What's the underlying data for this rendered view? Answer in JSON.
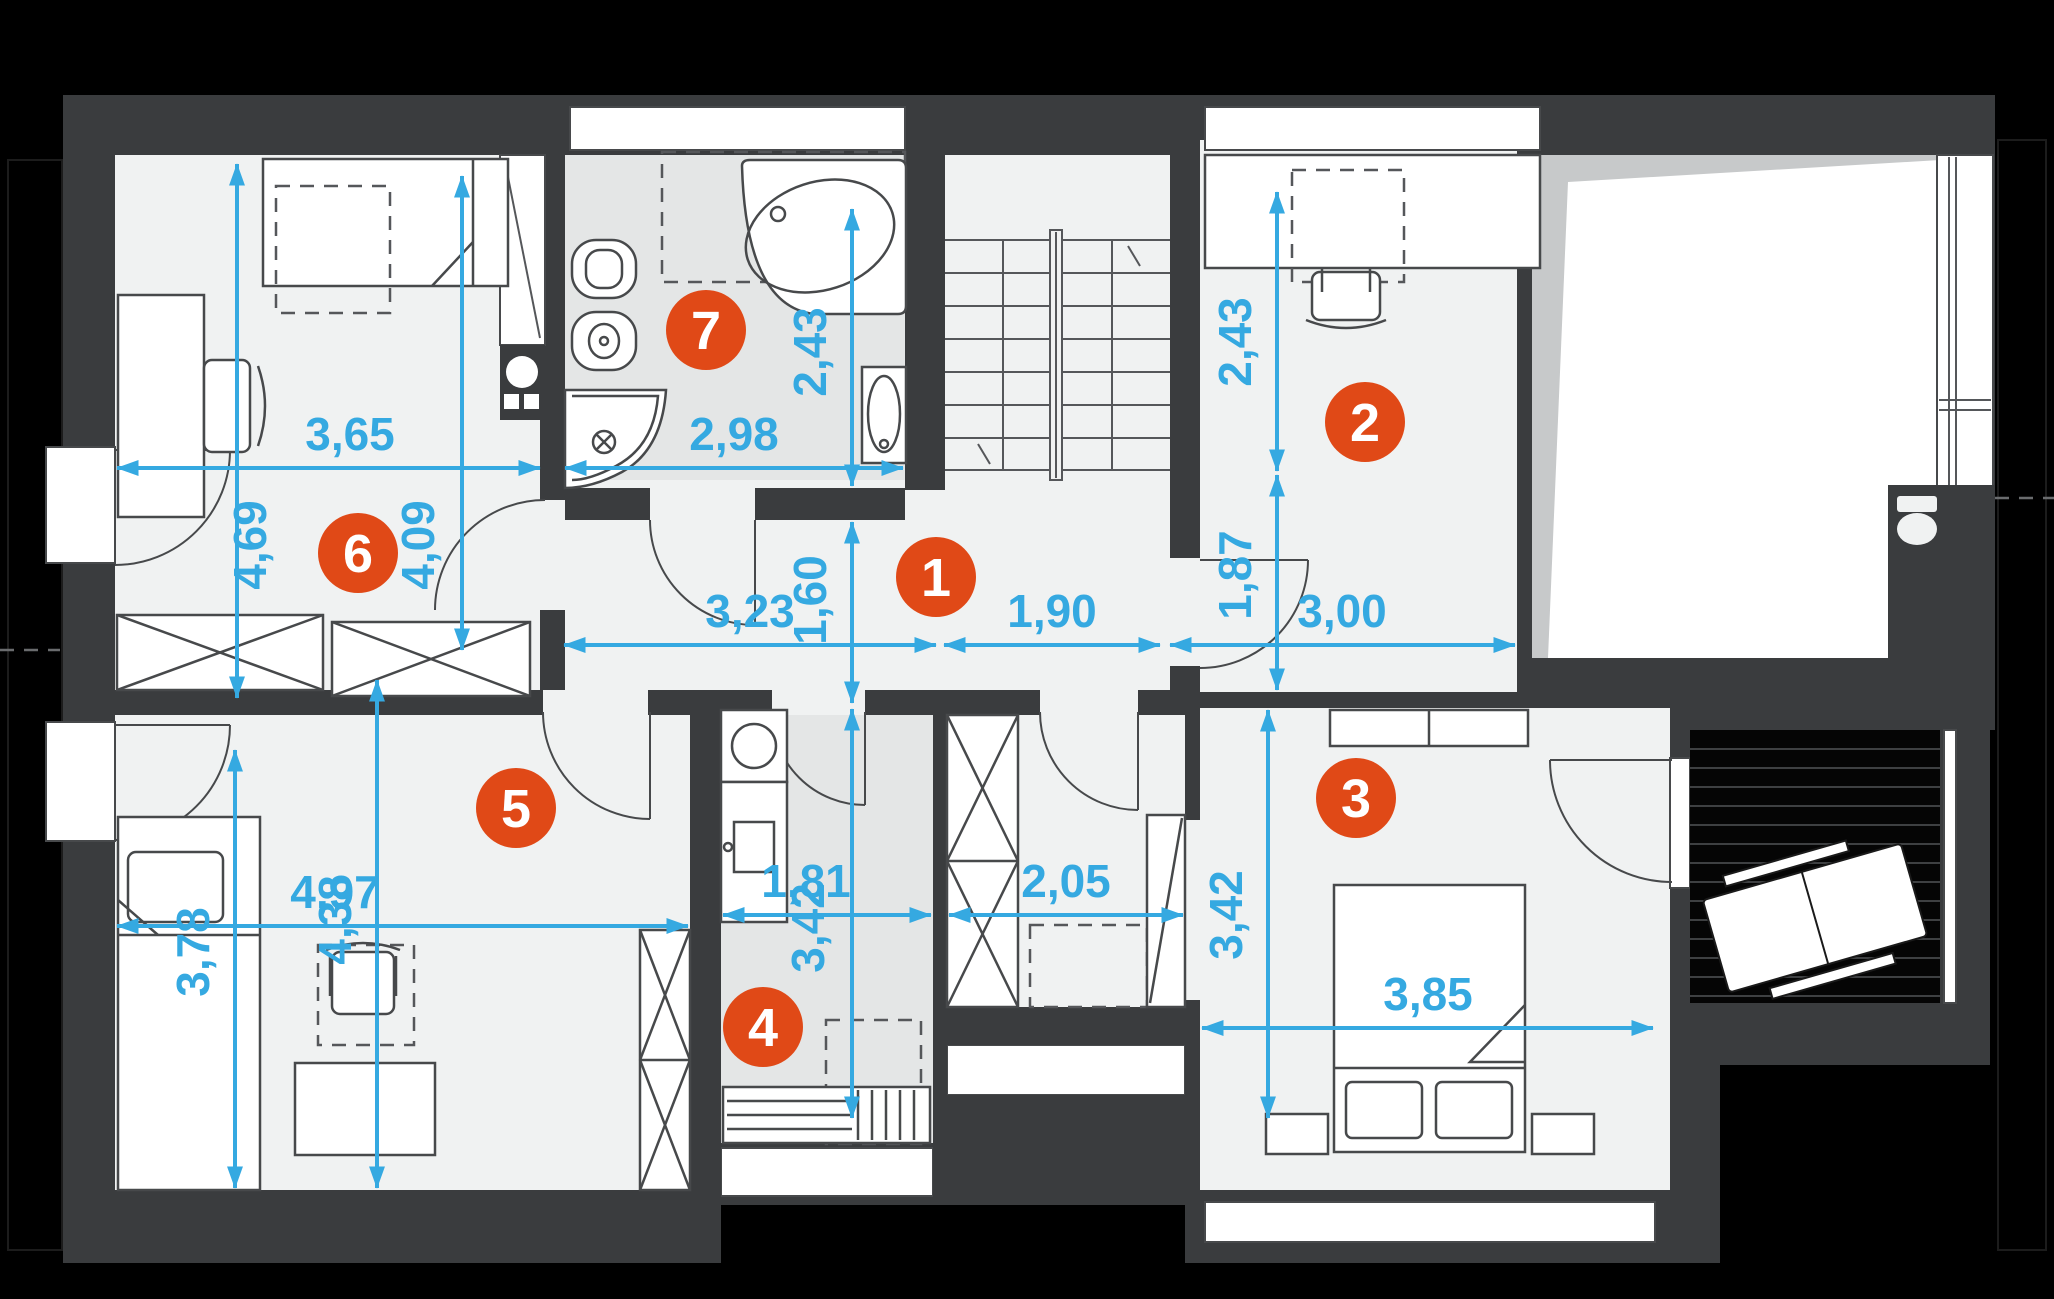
{
  "badges": {
    "hall": "1",
    "bedroom_top_right": "2",
    "bedroom_bottom_right": "3",
    "laundry": "4",
    "bedroom_bottom_left": "5",
    "bedroom_top_left": "6",
    "bathroom": "7"
  },
  "dims": {
    "room6_width": "3,65",
    "room6_height_left": "4,69",
    "room6_height_right": "4,09",
    "bath_width": "2,98",
    "bath_height": "2,43",
    "hall_width_left": "3,23",
    "hall_width_right": "1,90",
    "hall_height": "1,60",
    "room2_width": "3,00",
    "room2_height_upper": "2,43",
    "room2_height_lower": "1,87",
    "room5_width": "4,97",
    "room5_height_left": "3,78",
    "room5_height_right": "4,38",
    "room4_width": "1,81",
    "room4_height": "3,42",
    "closet_width": "2,05",
    "room3_width": "3,85",
    "room3_height": "3,42"
  },
  "colors": {
    "accent_blue": "#35a9e1",
    "badge_orange": "#e04917",
    "wall_gray": "#3a3c3e",
    "floor_light": "#f0f2f2",
    "floor_wet": "#e4e6e6",
    "deck_black": "#050505"
  }
}
